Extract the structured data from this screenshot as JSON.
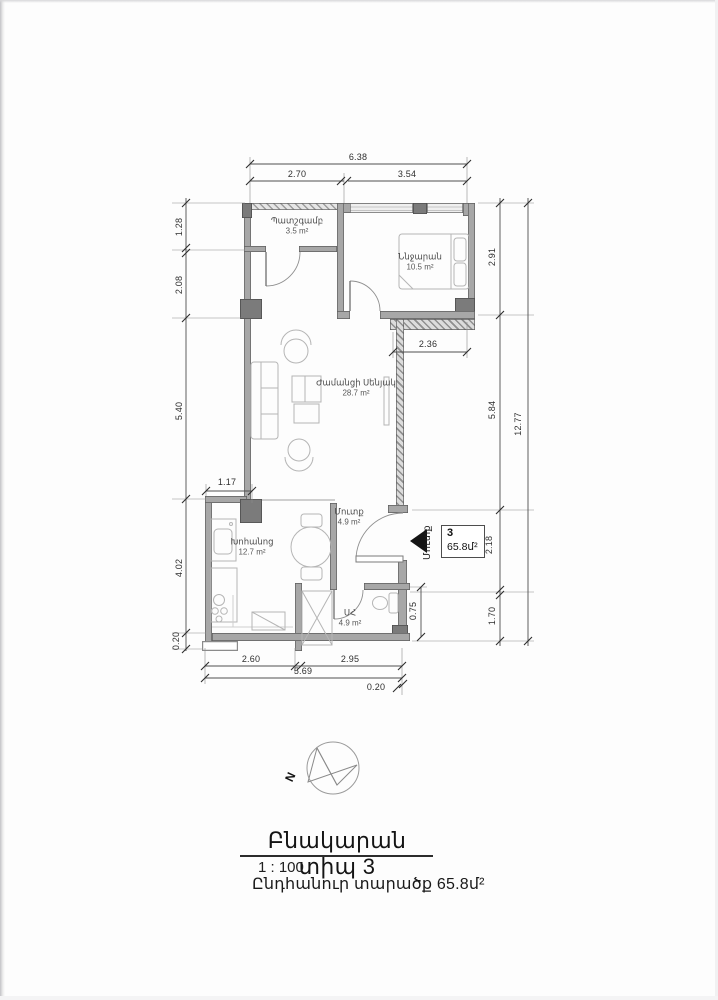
{
  "rooms": {
    "balcony": {
      "name": "Պատշգամբ",
      "area": "3.5 m²"
    },
    "bedroom": {
      "name": "Ննջարան",
      "area": "10.5 m²"
    },
    "living": {
      "name": "Ժամանցի Սենյակ",
      "area": "28.7 m²"
    },
    "hall": {
      "name": "Մուտք",
      "area": "4.9 m²"
    },
    "kitchen": {
      "name": "Խոհանոց",
      "area": "12.7 m²"
    },
    "bathroom": {
      "name": "ՍՀ",
      "area": "4.9 m²"
    }
  },
  "entry": {
    "apartment_number": "3",
    "apartment_area": "65.8մ²",
    "arrow_label": "Մուտք"
  },
  "dimensions": {
    "top_total": "6.38",
    "top_left": "2.70",
    "top_right": "3.54",
    "left_1": "1.28",
    "left_2": "2.08",
    "left_3": "5.40",
    "left_4": "4.02",
    "left_5": "0.20",
    "kitchen_step": "1.17",
    "niche_width": "2.36",
    "right_1": "2.91",
    "right_2": "5.84",
    "right_3": "2.18",
    "right_4": "1.70",
    "right_total": "12.77",
    "right_bottom": "0.75",
    "bottom_left": "2.60",
    "bottom_right": "2.95",
    "bottom_total": "5.69",
    "bottom_offset": "0.20"
  },
  "compass": {
    "north_label": "N"
  },
  "title_block": {
    "title": "Բնակարան տիպ 3",
    "scale": "1 : 100",
    "total_area": "Ընդհանուր տարածք 65.8մ²"
  },
  "colors": {
    "wall": "#a7a7a7",
    "column": "#7b7b7b",
    "dim_line": "#4f4f4f",
    "furniture": "#b5b5b5",
    "arrow": "#151515"
  }
}
